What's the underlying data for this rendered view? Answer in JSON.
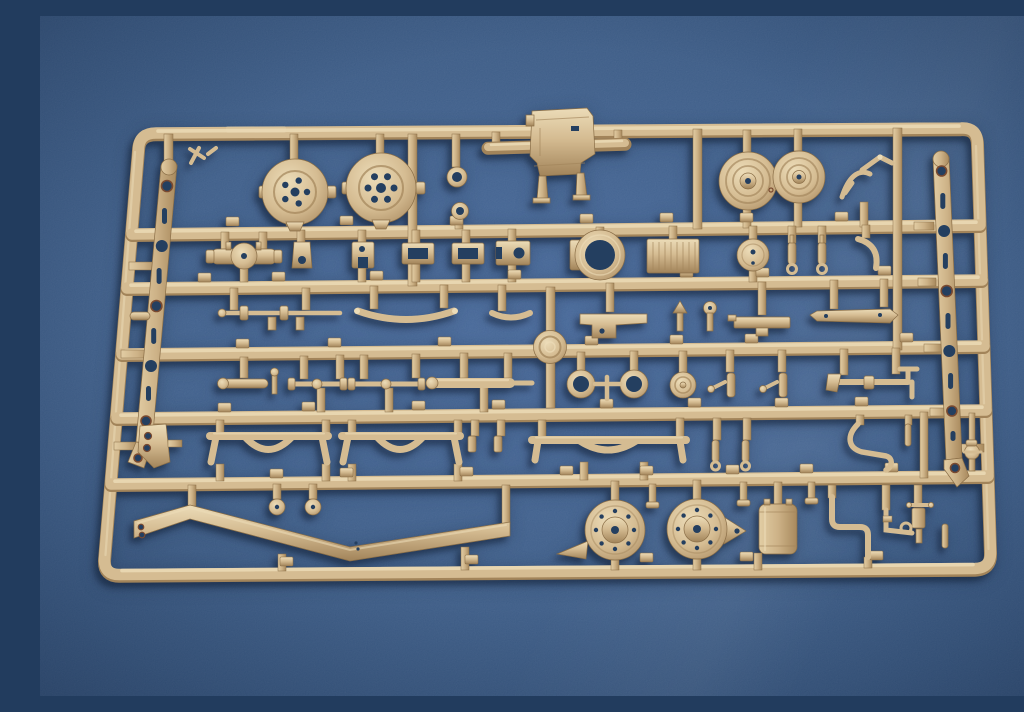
{
  "scene": {
    "type": "photograph",
    "subject": "tan plastic model-kit sprue on blue background",
    "description": "A single tan (dark-yellow styrene) injection-molded model kit sprue photographed at a slight angle on a textured medium-blue board. The rounded rectangular runner frame holds rows of small vehicle chassis parts: wheel hubs, grooved pulley wheels, perforated chassis side rails, axle housings, drive shafts, arched axle beams, leaf-spring bows, shock absorbers, blower fan housings, a cylindrical tank, an S-curved chassis beam and many small brackets, each attached by short runners with tiny molded part-number tabs.",
    "background_surface": "textured blue board with soft vignette",
    "text_visible": "none (molded part-number tabs and embossed brand stamp are illegible)"
  },
  "sprue": {
    "material_color_name": "tan / dark-yellow styrene",
    "frame": {
      "shape": "rounded rectangle, slightly rotated with mild perspective",
      "horizontal_runners": 7,
      "orientation": "landscape"
    },
    "parts_inventory": [
      {
        "name": "wheel-hub-drum",
        "count": 2,
        "zone": "top-left"
      },
      {
        "name": "gun-cradle-block",
        "count": 1,
        "zone": "top-center, rising above frame"
      },
      {
        "name": "grooved-pulley-wheel",
        "count": 2,
        "zone": "top-right"
      },
      {
        "name": "twig-branch-linkage",
        "count": 1,
        "zone": "top-right"
      },
      {
        "name": "perforated-chassis-side-rail",
        "count": 2,
        "zone": "inside left edge and right edge"
      },
      {
        "name": "axle-differential-housing",
        "count": 1,
        "zone": "row 2 left"
      },
      {
        "name": "equipment-box-frame",
        "count": 2,
        "zone": "row 2 center"
      },
      {
        "name": "ring-flange",
        "count": 1,
        "zone": "row 2 center-right"
      },
      {
        "name": "ribbed-radiator-box",
        "count": 1,
        "zone": "row 2 right"
      },
      {
        "name": "round-cover",
        "count": 1,
        "zone": "row 2 right"
      },
      {
        "name": "shock-absorber",
        "count": 2,
        "zone": "row 2 right"
      },
      {
        "name": "tie-rod",
        "count": 2,
        "zone": "row 3 left"
      },
      {
        "name": "curved-bumper-bow",
        "count": 2,
        "zone": "row 3 center"
      },
      {
        "name": "embossed-logo-disc",
        "count": 1,
        "zone": "center, molded on runner"
      },
      {
        "name": "drive-shaft",
        "count": 3,
        "zone": "row 4"
      },
      {
        "name": "twin-ring-link",
        "count": 1,
        "zone": "row 4 center"
      },
      {
        "name": "cone-disc",
        "count": 1,
        "zone": "row 4"
      },
      {
        "name": "steering-knuckle",
        "count": 2,
        "zone": "row 4 right"
      },
      {
        "name": "t-pipe-rod",
        "count": 1,
        "zone": "row 4 right"
      },
      {
        "name": "arched-axle-beam",
        "count": 3,
        "zone": "row 5"
      },
      {
        "name": "hook-bracket",
        "count": 1,
        "zone": "row 5 far left"
      },
      {
        "name": "bent-exhaust-pipe",
        "count": 1,
        "zone": "row 5 right"
      },
      {
        "name": "s-curved-chassis-beam",
        "count": 1,
        "zone": "bottom left"
      },
      {
        "name": "stem-disc",
        "count": 2,
        "zone": "bottom left"
      },
      {
        "name": "blower-fan-housing",
        "count": 2,
        "zone": "bottom center"
      },
      {
        "name": "cylindrical-tank",
        "count": 1,
        "zone": "bottom center-right"
      },
      {
        "name": "z-bend-bracket",
        "count": 2,
        "zone": "bottom right"
      },
      {
        "name": "hand-pump",
        "count": 1,
        "zone": "bottom right"
      },
      {
        "name": "molded-number-tab",
        "count": "many",
        "zone": "on runners beside each part"
      }
    ]
  },
  "colors": {
    "bg_center": "#46689a",
    "bg_mid": "#3a5a85",
    "bg_corner": "#2c4a72",
    "tan_hi": "#ecdcb8",
    "tan_mid": "#d5bc92",
    "tan_dark": "#a2845a",
    "tan_edge": "#8a6e47",
    "hole_dark": "#243f60",
    "rim_rust": "#7a4a30"
  }
}
